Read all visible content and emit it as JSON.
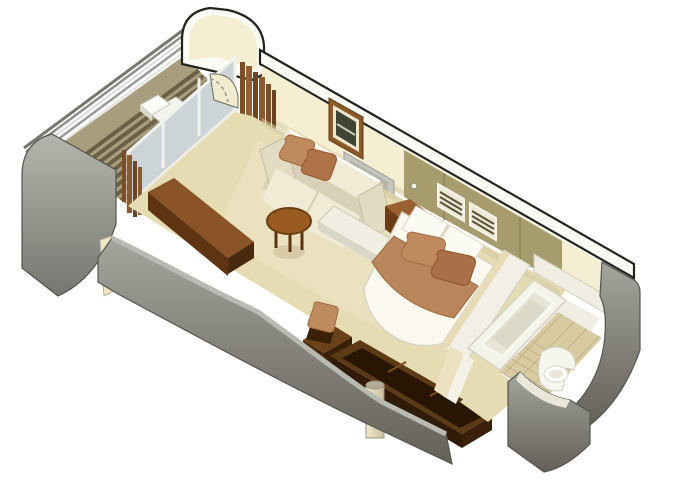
{
  "scene": {
    "type": "isometric-stateroom-floorplan-rendering",
    "elements": [
      "balcony-railing",
      "balcony-deck",
      "sun-lounger",
      "balcony-divider-wall",
      "divider-wall-cut",
      "sliding-glass-door",
      "curtains",
      "living-area-floor",
      "sofa",
      "throw-pillows",
      "coffee-table",
      "sideboard",
      "wall-picture",
      "vanity-mirror",
      "vanity-counter",
      "wardrobe-louvre-vents",
      "wardrobe-knob",
      "nightstand",
      "double-bed",
      "bed-runner",
      "bed-pillows",
      "desk-unit",
      "desk-chair",
      "structural-column",
      "bathroom-partition-wall",
      "bathtub",
      "toilet",
      "bathroom-tile-floor",
      "bathroom-doorway",
      "hull-side-wall",
      "corridor-side-wall"
    ]
  },
  "palette": {
    "background": "#ffffff",
    "outline": "#22221e",
    "wall_cream": "#f6eed2",
    "wall_band_white": "#fcfcf6",
    "wall_gray": "#8f9088",
    "wall_gray_dark": "#6a6b64",
    "floor_beige": "#e6dcb4",
    "floor_light": "#efe7cc",
    "deck_wood": "#a89d7c",
    "deck_stripe": "#6b5f45",
    "railing_gray": "#9a9a96",
    "glass_blue": "#ccd4d7",
    "frame_white": "#f2f2ec",
    "curtain_brown": "#8a5a31",
    "closet_olive": "#a69c6d",
    "closet_olive_dark": "#8d8356",
    "furniture_brown": "#9a5b20",
    "sideboard_brown": "#8a5426",
    "desk_brown_dark": "#281504",
    "desk_brown_rim": "#5c3a16",
    "accent_copper": "#c08a5f",
    "upholstery_cream": "#f1ebd6",
    "bed_white": "#faf8ef",
    "bed_runner": "#b9855a",
    "tile_tan": "#d8cba2",
    "tile_line": "#bfb189",
    "fixture_white": "#f4f3ea"
  }
}
